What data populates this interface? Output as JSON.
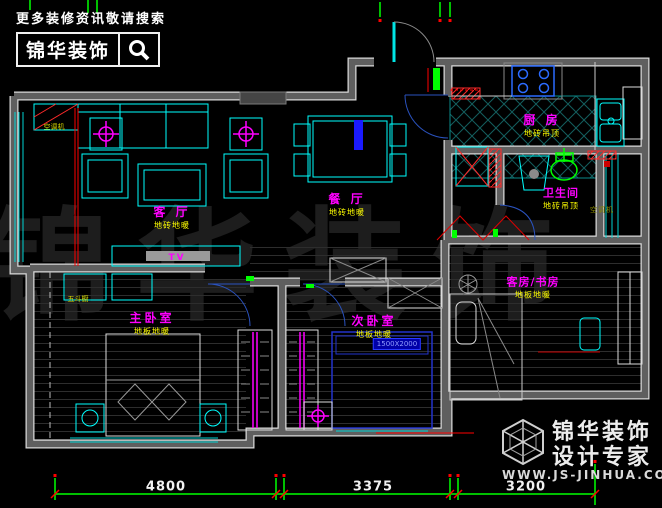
{
  "header": {
    "tagline": "更多装修资讯敬请搜索",
    "brand": "锦华装饰",
    "search_icon": "magnifier"
  },
  "watermark": "锦华装饰",
  "rooms": {
    "living": {
      "name": "客 厅",
      "finish": "地砖地暖"
    },
    "dining": {
      "name": "餐 厅",
      "finish": "地砖地暖"
    },
    "kitchen": {
      "name": "厨 房",
      "finish": "地砖吊顶"
    },
    "bathroom": {
      "name": "卫生间",
      "finish": "地砖吊顶"
    },
    "master": {
      "name": "主卧室",
      "finish": "地板地暖"
    },
    "secondary": {
      "name": "次卧室",
      "finish": "地板地暖"
    },
    "guest": {
      "name": "客房/书房",
      "finish": "地板地暖"
    }
  },
  "annotations": {
    "tv": "TV",
    "bed_size": "1500X2000",
    "ac_outdoor": "空调机",
    "ac_platform": "空调机",
    "dresser": "五斗橱"
  },
  "dimensions": {
    "d1": "4800",
    "d2": "3375",
    "d3": "3200"
  },
  "footer": {
    "brand_line1": "锦华装饰",
    "brand_line2": "设计专家",
    "website": "WWW.JS-JINHUA.COM"
  },
  "colors": {
    "wall": "#5f5f5f",
    "furniture_cyan": "#00ffff",
    "label_magenta": "#ff00ff",
    "finish_yellow": "#ffff00",
    "dimension_green": "#00ff00",
    "accent_red": "#ff0000",
    "door_blue": "#2a52be",
    "bed_blue": "#2233cc"
  }
}
